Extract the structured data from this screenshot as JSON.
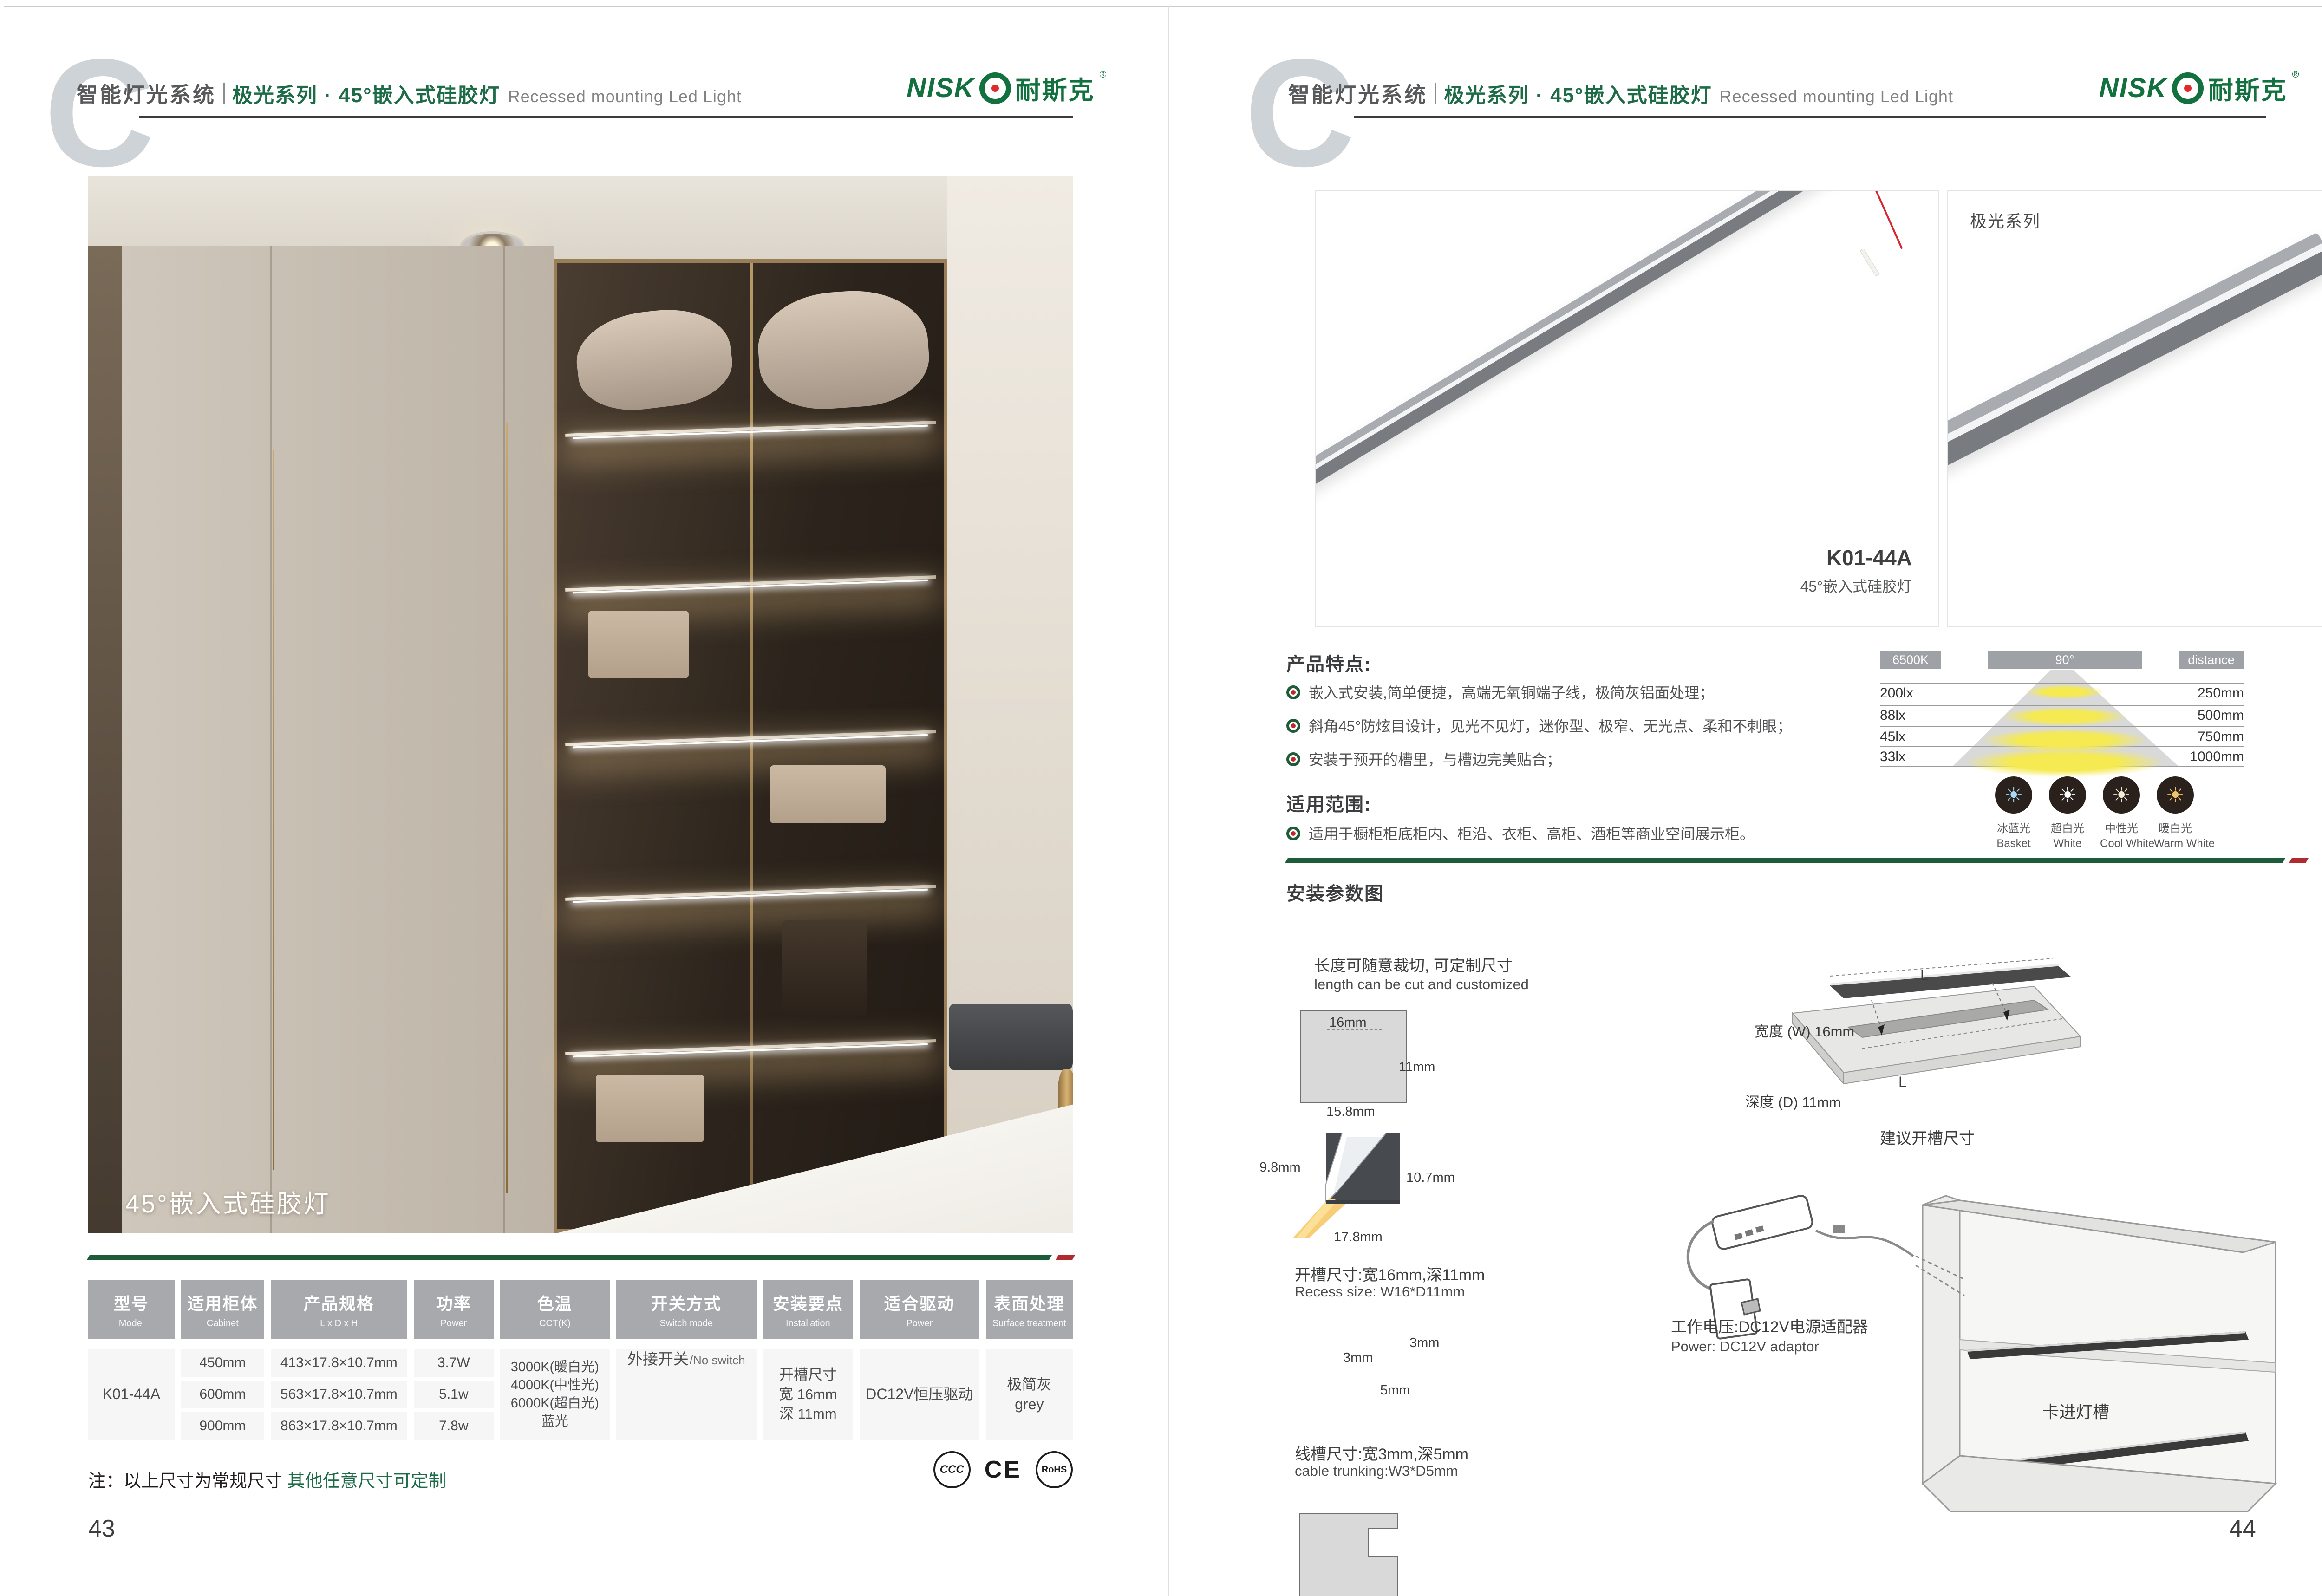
{
  "colors": {
    "brand-green": "#1e6b47",
    "divider-green": "#1d5b39",
    "accent-red": "#b02a30",
    "logo-green": "#13713f",
    "logo-red": "#e02b2b",
    "header-gray": "#a7a9ac",
    "text-dark": "#3e3f41",
    "text-gray": "#808285",
    "cell-bg": "#f6f6f7",
    "rule-dark": "#3c3c3c",
    "c-gray": "#cdd3d7",
    "cone-yellow": "#f2e34d"
  },
  "header": {
    "brand_c": "C",
    "title_cn": "智能灯光系统",
    "series": "极光系列 · 45°嵌入式硅胶灯",
    "subtitle_en": "Recessed mounting Led Light"
  },
  "logo": {
    "latin": "NISK",
    "cn": "耐斯克",
    "reg": "®"
  },
  "left": {
    "photo_caption": "45°嵌入式硅胶灯",
    "table": {
      "headers": [
        {
          "cn": "型号",
          "en": "Model"
        },
        {
          "cn": "适用柜体",
          "en": "Cabinet"
        },
        {
          "cn": "产品规格",
          "en": "L x D x H"
        },
        {
          "cn": "功率",
          "en": "Power"
        },
        {
          "cn": "色温",
          "en": "CCT(K)"
        },
        {
          "cn": "开关方式",
          "en": "Switch mode"
        },
        {
          "cn": "安装要点",
          "en": "Installation"
        },
        {
          "cn": "适合驱动",
          "en": "Power"
        },
        {
          "cn": "表面处理",
          "en": "Surface treatment"
        }
      ],
      "model": "K01-44A",
      "cabinet": [
        "450mm",
        "600mm",
        "900mm"
      ],
      "specs": [
        "413×17.8×10.7mm",
        "563×17.8×10.7mm",
        "863×17.8×10.7mm"
      ],
      "power": [
        "3.7W",
        "5.1w",
        "7.8w"
      ],
      "cct": [
        "3000K(暖白光)",
        "4000K(中性光)",
        "6000K(超白光)",
        "蓝光"
      ],
      "switch_cn": "外接开关",
      "switch_en": "/No switch",
      "install": [
        "开槽尺寸",
        "宽 16mm",
        "深 11mm"
      ],
      "driver": "DC12V恒压驱动",
      "surface_cn": "极简灰",
      "surface_en": "grey"
    },
    "note_black": "注：以上尺寸为常规尺寸 ",
    "note_green": "其他任意尺寸可定制",
    "certs": [
      "CCC",
      "CE",
      "RoHS"
    ],
    "page_number": "43"
  },
  "right": {
    "product": {
      "series_label": "极光系列",
      "model": "K01-44A",
      "model_sub": "45°嵌入式硅胶灯"
    },
    "features": {
      "title": "产品特点:",
      "items": [
        "嵌入式安装,简单便捷，高端无氧铜端子线，极简灰铝面处理；",
        "斜角45°防炫目设计，见光不见灯，迷你型、极窄、无光点、柔和不刺眼；",
        "安装于预开的槽里，与槽边完美贴合；"
      ]
    },
    "scope": {
      "title": "适用范围:",
      "item": "适用于橱柜柜底柜内、柜沿、衣柜、高柜、酒柜等商业空间展示柜。"
    },
    "beam": {
      "cct": "6500K",
      "angle": "90°",
      "distance_label": "distance",
      "rows": [
        {
          "lux": "200lx",
          "mm": "250mm"
        },
        {
          "lux": "88lx",
          "mm": "500mm"
        },
        {
          "lux": "45lx",
          "mm": "750mm"
        },
        {
          "lux": "33lx",
          "mm": "1000mm"
        }
      ]
    },
    "cct_icons": [
      {
        "cn": "冰蓝光",
        "en": "Basket",
        "color": "#a8d8f5"
      },
      {
        "cn": "超白光",
        "en": "White",
        "color": "#ffffff"
      },
      {
        "cn": "中性光",
        "en": "Cool White",
        "color": "#f6ecd4"
      },
      {
        "cn": "暖白光",
        "en": "Warm White",
        "color": "#f0c36a"
      }
    ],
    "install": {
      "title": "安装参数图",
      "cut_cn": "长度可随意裁切, 可定制尺寸",
      "cut_en": "length can be cut and customized",
      "dim_16": "16mm",
      "dim_11": "11mm",
      "dim_158": "15.8mm",
      "dim_98": "9.8mm",
      "dim_107": "10.7mm",
      "dim_178": "17.8mm",
      "recess_cn": "开槽尺寸:宽16mm,深11mm",
      "recess_en": "Recess size: W16*D11mm",
      "dim_3a": "3mm",
      "dim_3b": "3mm",
      "dim_5": "5mm",
      "trunk_cn": "线槽尺寸:宽3mm,深5mm",
      "trunk_en": "cable trunking:W3*D5mm",
      "len_l_top": "L",
      "len_l_board": "L",
      "board_w": "宽度 (W) 16mm",
      "board_d": "深度 (D) 11mm",
      "board_caption": "建议开槽尺寸",
      "power_cn": "工作电压:DC12V电源适配器",
      "power_en": "Power: DC12V adaptor",
      "cabinet_label": "卡进灯槽"
    },
    "page_number": "44"
  }
}
